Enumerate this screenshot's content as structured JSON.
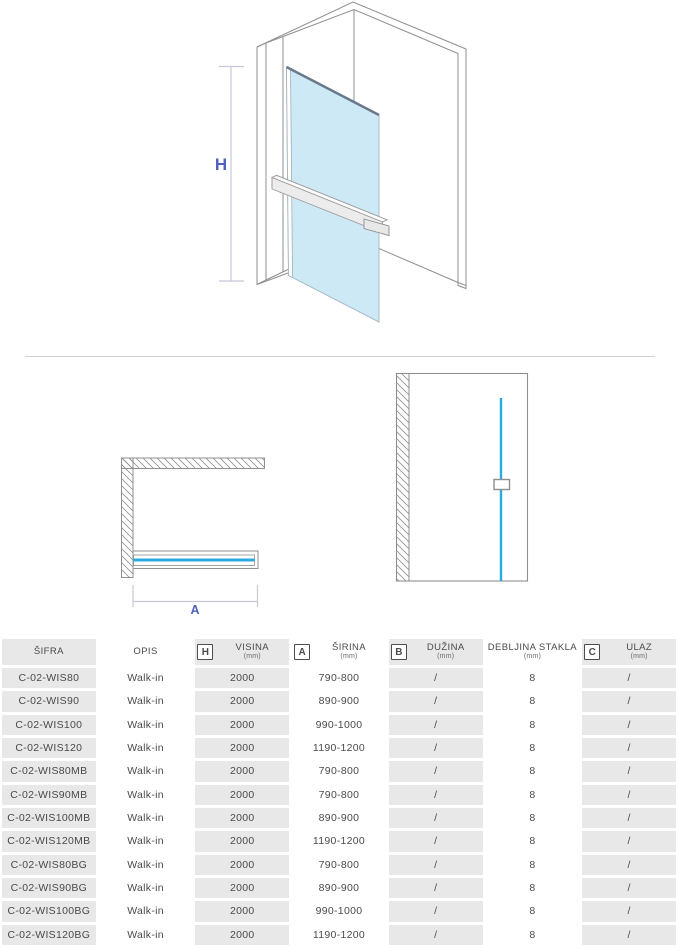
{
  "colors": {
    "accent_cyan": "#29abe2",
    "glass_fill": "#cde9f5",
    "glass_edge": "#68798a",
    "outline_gray": "#8f8f8f",
    "dim_line": "#c6c8d8",
    "label_blue": "#5061bd",
    "cell_gray": "#e8e8e8",
    "text_dark": "#4a4a4a"
  },
  "drawing": {
    "height_label": "H",
    "width_label": "A"
  },
  "table": {
    "headers": [
      {
        "icon": "",
        "label": "ŠIFRA",
        "unit": ""
      },
      {
        "icon": "",
        "label": "OPIS",
        "unit": ""
      },
      {
        "icon": "H",
        "label": "VISINA",
        "unit": "(mm)"
      },
      {
        "icon": "A",
        "label": "ŠIRINA",
        "unit": "(mm)"
      },
      {
        "icon": "B",
        "label": "DUŽINA",
        "unit": "(mm)"
      },
      {
        "icon": "",
        "label": "DEBLJINA STAKLA",
        "unit": "(mm)"
      },
      {
        "icon": "C",
        "label": "ULAZ",
        "unit": "(mm)"
      }
    ],
    "rows": [
      [
        "C-02-WIS80",
        "Walk-in",
        "2000",
        "790-800",
        "/",
        "8",
        "/"
      ],
      [
        "C-02-WIS90",
        "Walk-in",
        "2000",
        "890-900",
        "/",
        "8",
        "/"
      ],
      [
        "C-02-WIS100",
        "Walk-in",
        "2000",
        "990-1000",
        "/",
        "8",
        "/"
      ],
      [
        "C-02-WIS120",
        "Walk-in",
        "2000",
        "1190-1200",
        "/",
        "8",
        "/"
      ],
      [
        "C-02-WIS80MB",
        "Walk-in",
        "2000",
        "790-800",
        "/",
        "8",
        "/"
      ],
      [
        "C-02-WIS90MB",
        "Walk-in",
        "2000",
        "790-800",
        "/",
        "8",
        "/"
      ],
      [
        "C-02-WIS100MB",
        "Walk-in",
        "2000",
        "890-900",
        "/",
        "8",
        "/"
      ],
      [
        "C-02-WIS120MB",
        "Walk-in",
        "2000",
        "1190-1200",
        "/",
        "8",
        "/"
      ],
      [
        "C-02-WIS80BG",
        "Walk-in",
        "2000",
        "790-800",
        "/",
        "8",
        "/"
      ],
      [
        "C-02-WIS90BG",
        "Walk-in",
        "2000",
        "890-900",
        "/",
        "8",
        "/"
      ],
      [
        "C-02-WIS100BG",
        "Walk-in",
        "2000",
        "990-1000",
        "/",
        "8",
        "/"
      ],
      [
        "C-02-WIS120BG",
        "Walk-in",
        "2000",
        "1190-1200",
        "/",
        "8",
        "/"
      ]
    ]
  }
}
